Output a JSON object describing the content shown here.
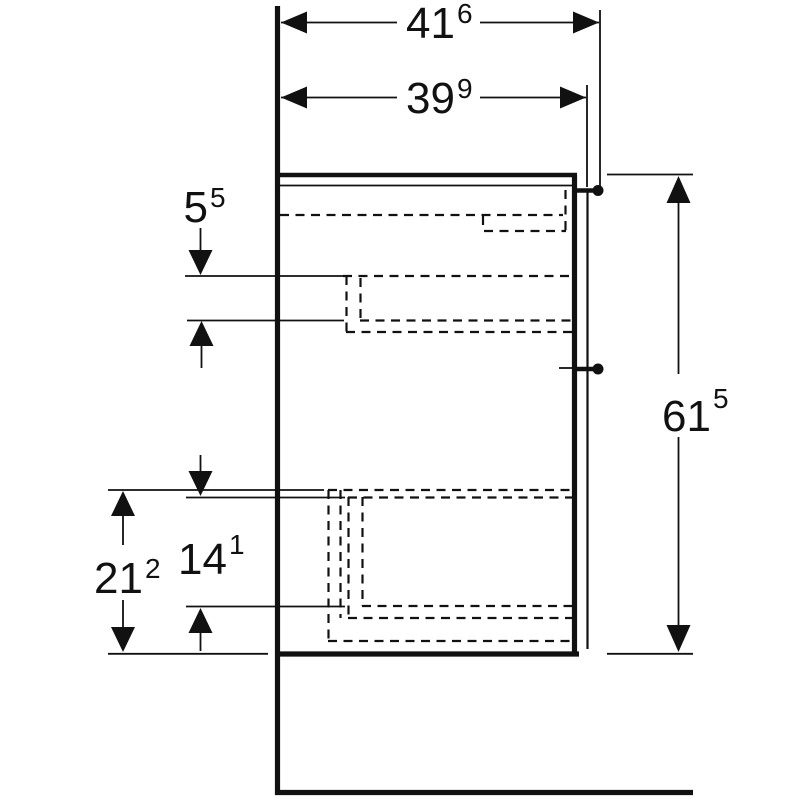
{
  "drawing": {
    "background_color": "#ffffff",
    "line_color": "#111111"
  },
  "dimensions": {
    "width_outer": {
      "value": "41",
      "superscript": "6"
    },
    "width_inner": {
      "value": "39",
      "superscript": "9"
    },
    "depth_top": {
      "value": "5",
      "superscript": "5"
    },
    "height_overall": {
      "value": "61",
      "superscript": "5"
    },
    "height_drawer_inner": {
      "value": "14",
      "superscript": "1"
    },
    "height_drawer_front": {
      "value": "21",
      "superscript": "2"
    }
  }
}
